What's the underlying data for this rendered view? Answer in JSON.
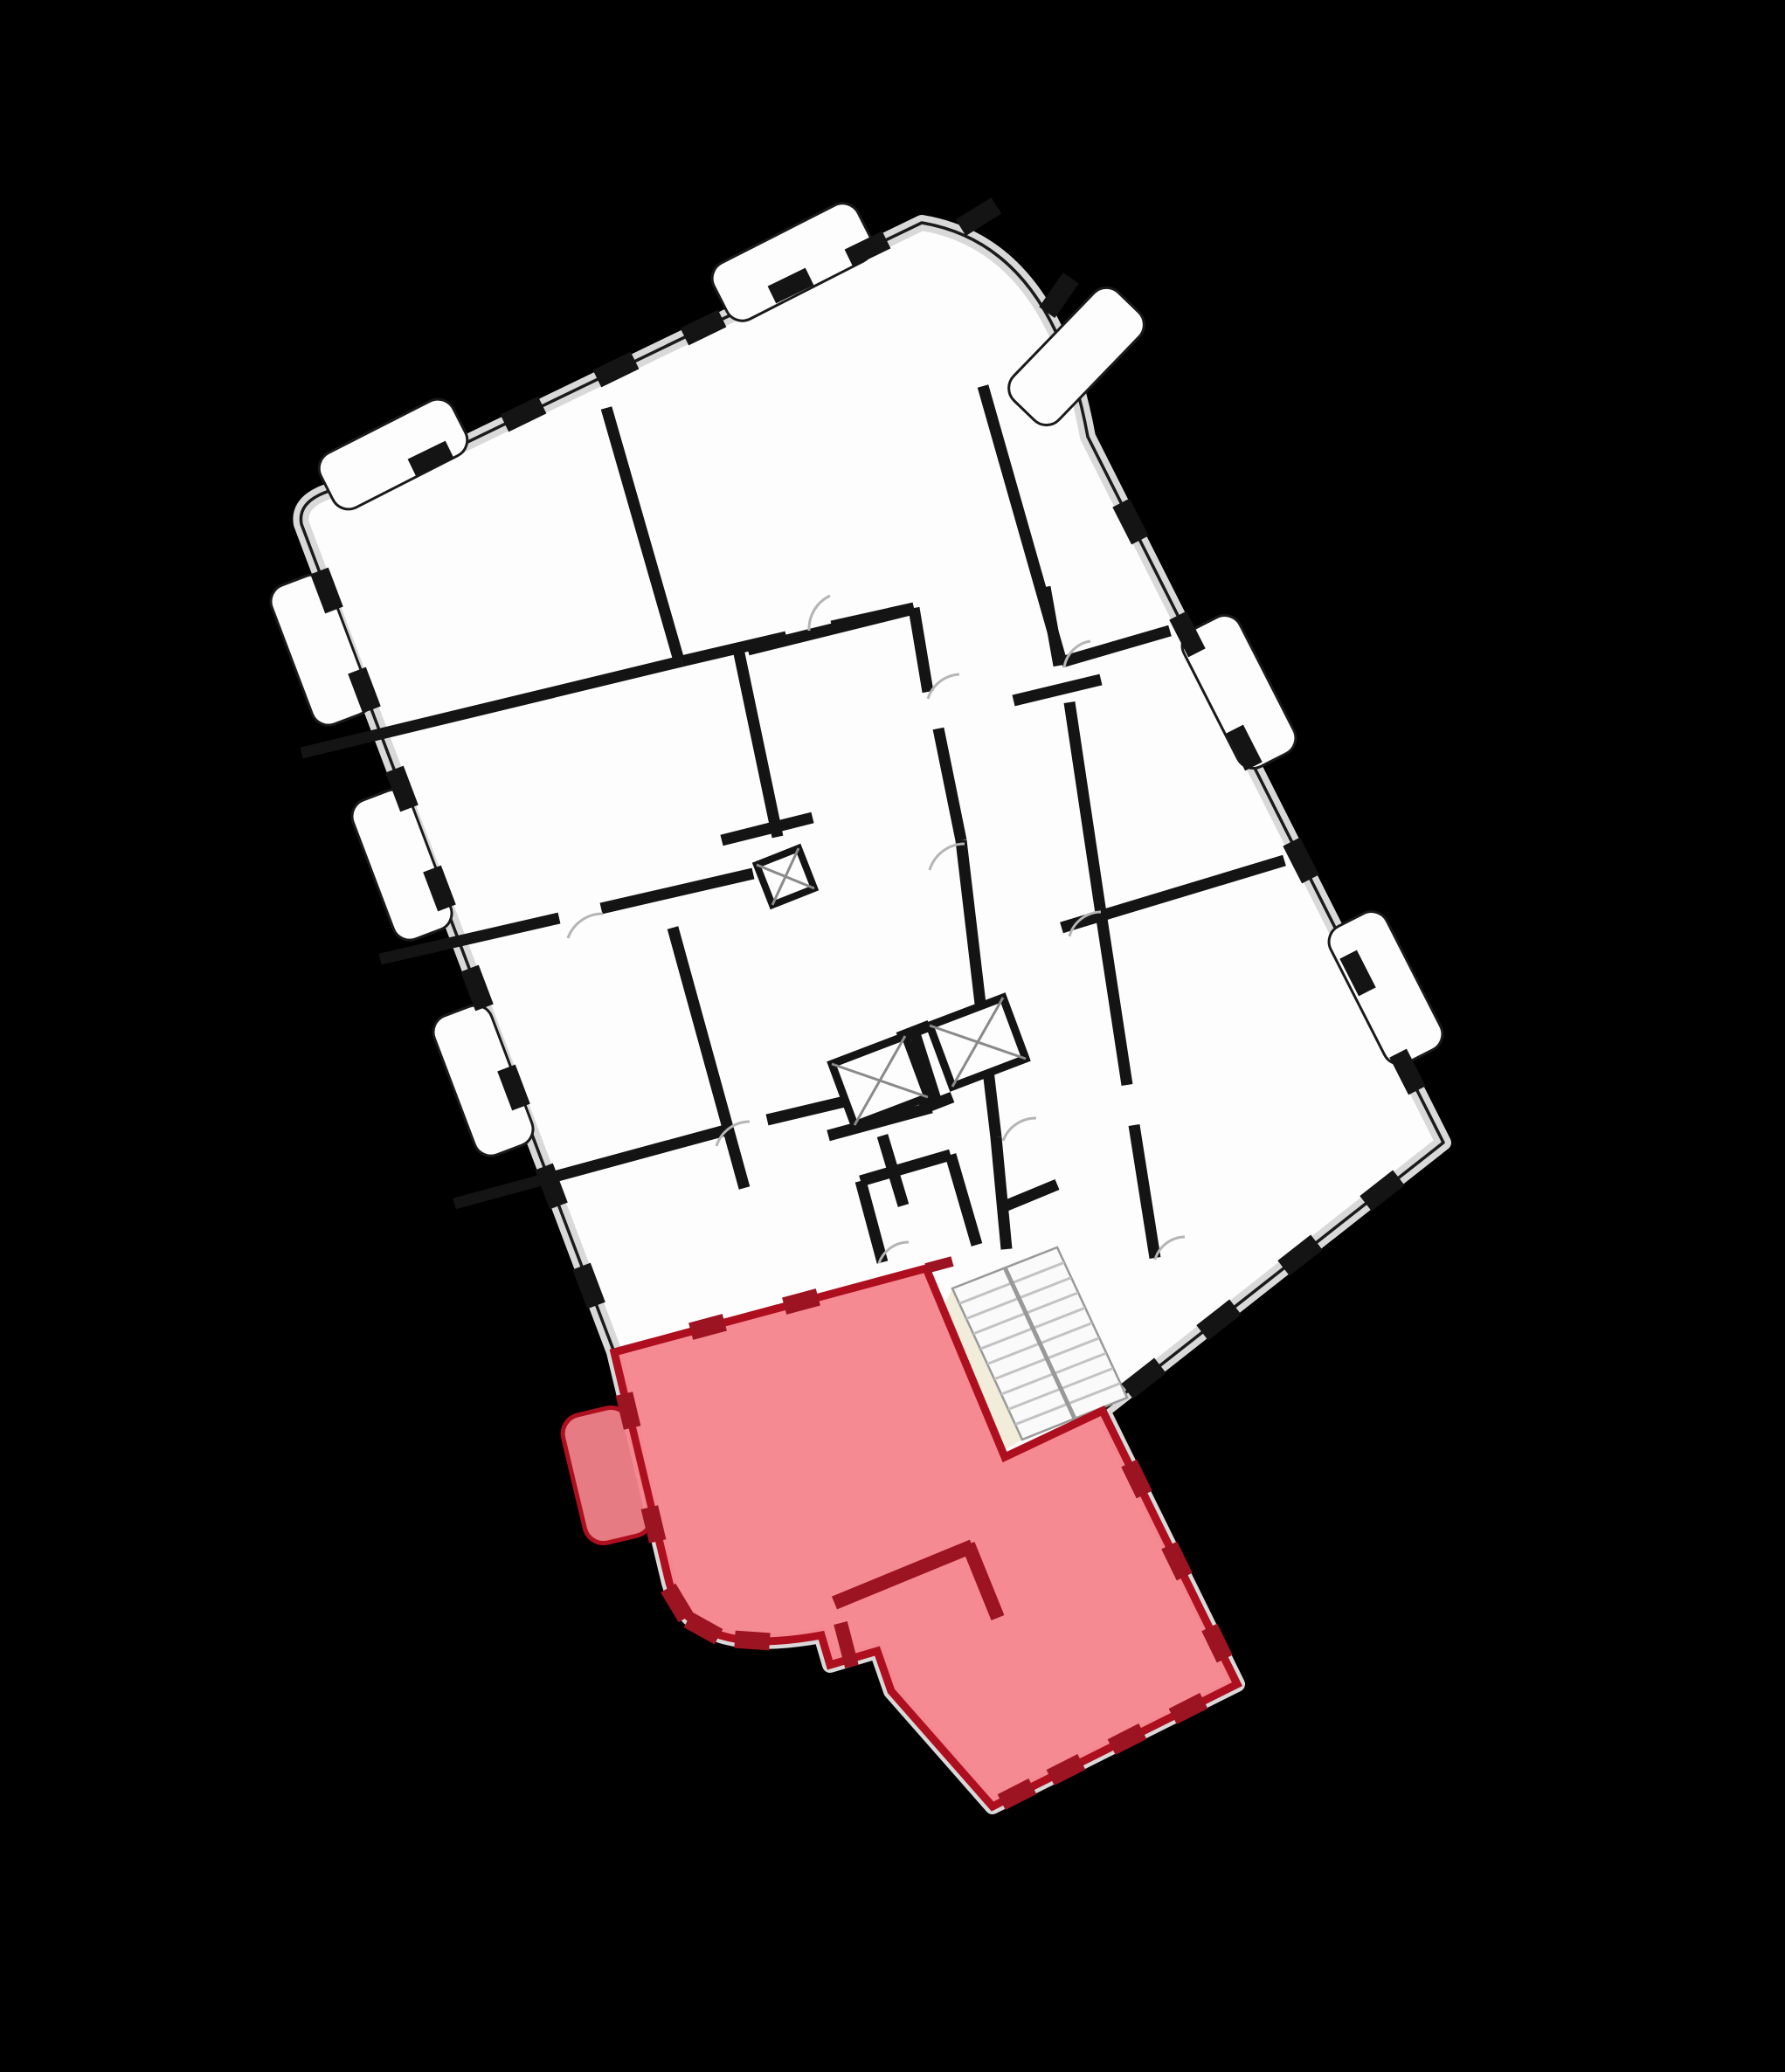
{
  "page": {
    "description": "building floor plan with one highlighted unit",
    "visible_text": ""
  },
  "colors": {
    "background": "#000000",
    "plan_fill": "#fdfdfd",
    "plan_band": "#d9d9d9",
    "plan_outline": "#1a1a1a",
    "wall": "#141414",
    "thin_line": "#999999",
    "door_arc": "#b5b5b5",
    "elevator_x": "#8a8a8a",
    "stair_tread": "#c3c3c3",
    "landing_fill": "#f2edda",
    "highlight_fill": "#f4838b",
    "highlight_border": "#ad0f1e",
    "highlight_wall": "#9c1322",
    "pier": "#141414"
  },
  "plan": {
    "kind": "residential-floor-plan",
    "rotation_look_deg": -26,
    "highlighted_unit": {
      "state": "selected",
      "position": "bottom"
    },
    "features": [
      "elevator-shafts",
      "stairwell",
      "balconies",
      "window-piers",
      "door-swings",
      "corner-curve"
    ]
  }
}
